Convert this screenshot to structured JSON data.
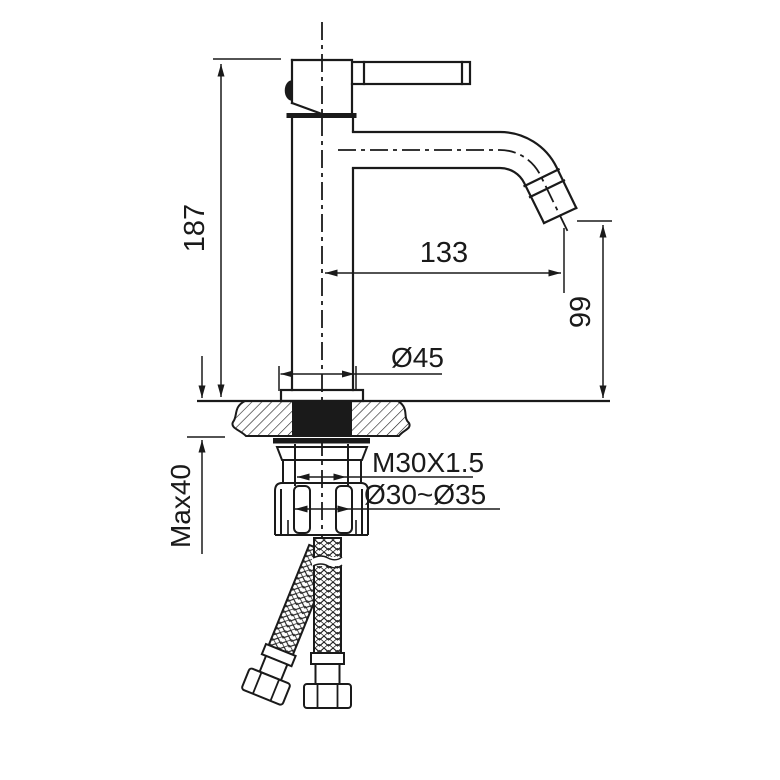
{
  "colors": {
    "line": "#1a1a1a",
    "background": "#ffffff"
  },
  "labels": {
    "overall_height": "187",
    "spout_reach": "133",
    "outlet_height": "99",
    "base_diameter": "Ø45",
    "thread_spec": "M30X1.5",
    "hole_diameter_range": "Ø30~Ø35",
    "max_counter_thickness": "Max40"
  }
}
